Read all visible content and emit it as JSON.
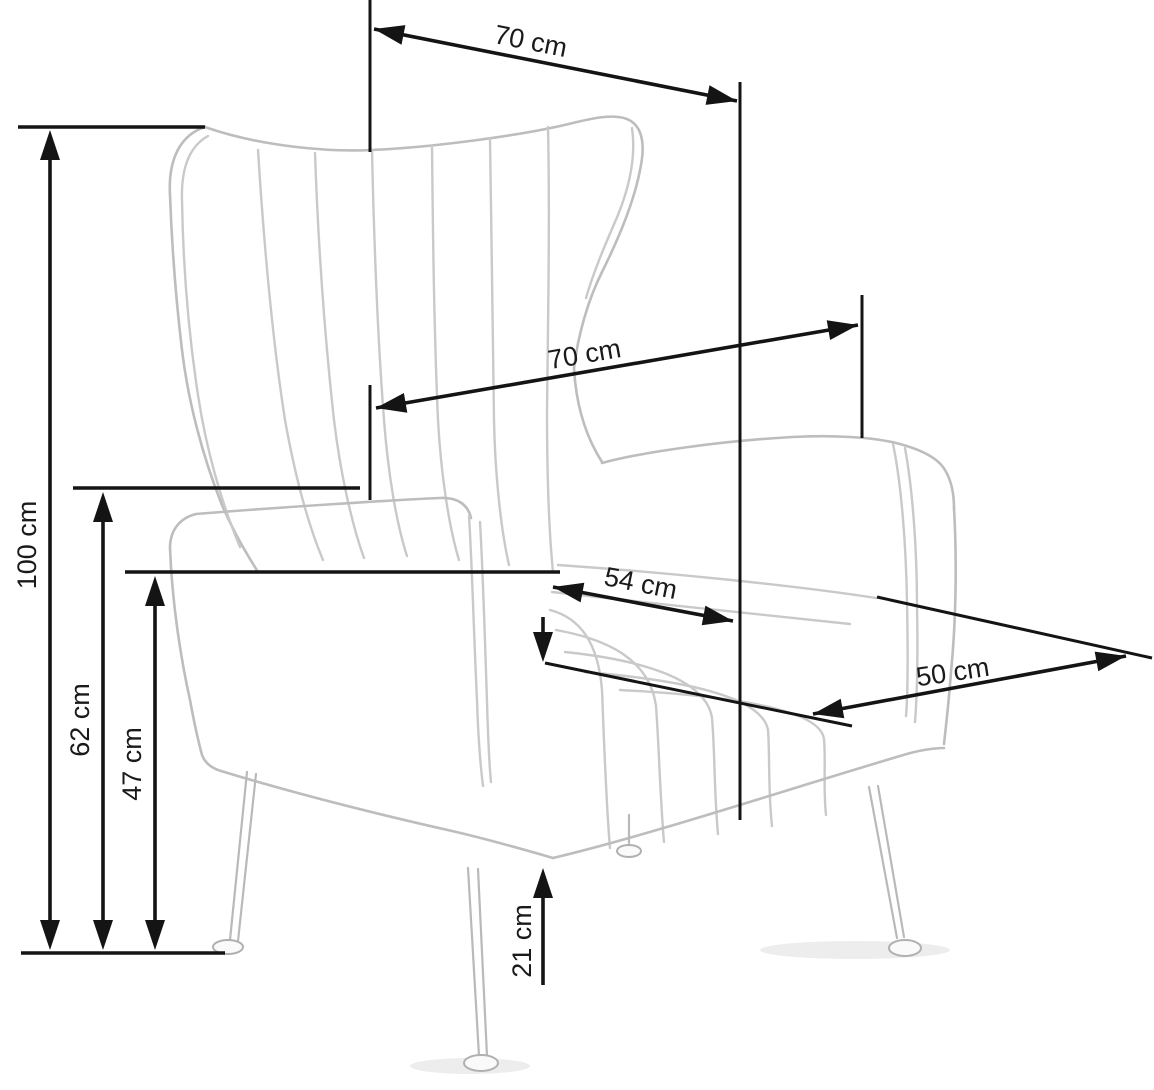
{
  "figure": {
    "kind": "furniture-dimension-diagram",
    "subject": "wingback armchair line sketch with measurement arrows",
    "unit": "cm",
    "background_color": "#ffffff",
    "dimension_color": "#141414",
    "sketch_color": "#c9c9c9"
  },
  "dimensions": [
    {
      "id": "top-depth",
      "label": "70 cm",
      "value": 70,
      "orientation": "diagonal-top"
    },
    {
      "id": "back-width",
      "label": "70 cm",
      "value": 70,
      "orientation": "diagonal-middle"
    },
    {
      "id": "overall-height",
      "label": "100 cm",
      "value": 100,
      "orientation": "vertical"
    },
    {
      "id": "armrest-height",
      "label": "62 cm",
      "value": 62,
      "orientation": "vertical"
    },
    {
      "id": "seat-height",
      "label": "47 cm",
      "value": 47,
      "orientation": "vertical"
    },
    {
      "id": "seat-width",
      "label": "54 cm",
      "value": 54,
      "orientation": "diagonal-seat"
    },
    {
      "id": "seat-depth",
      "label": "50 cm",
      "value": 50,
      "orientation": "diagonal-seat"
    },
    {
      "id": "leg-height",
      "label": "21 cm",
      "value": 21,
      "orientation": "vertical"
    }
  ]
}
